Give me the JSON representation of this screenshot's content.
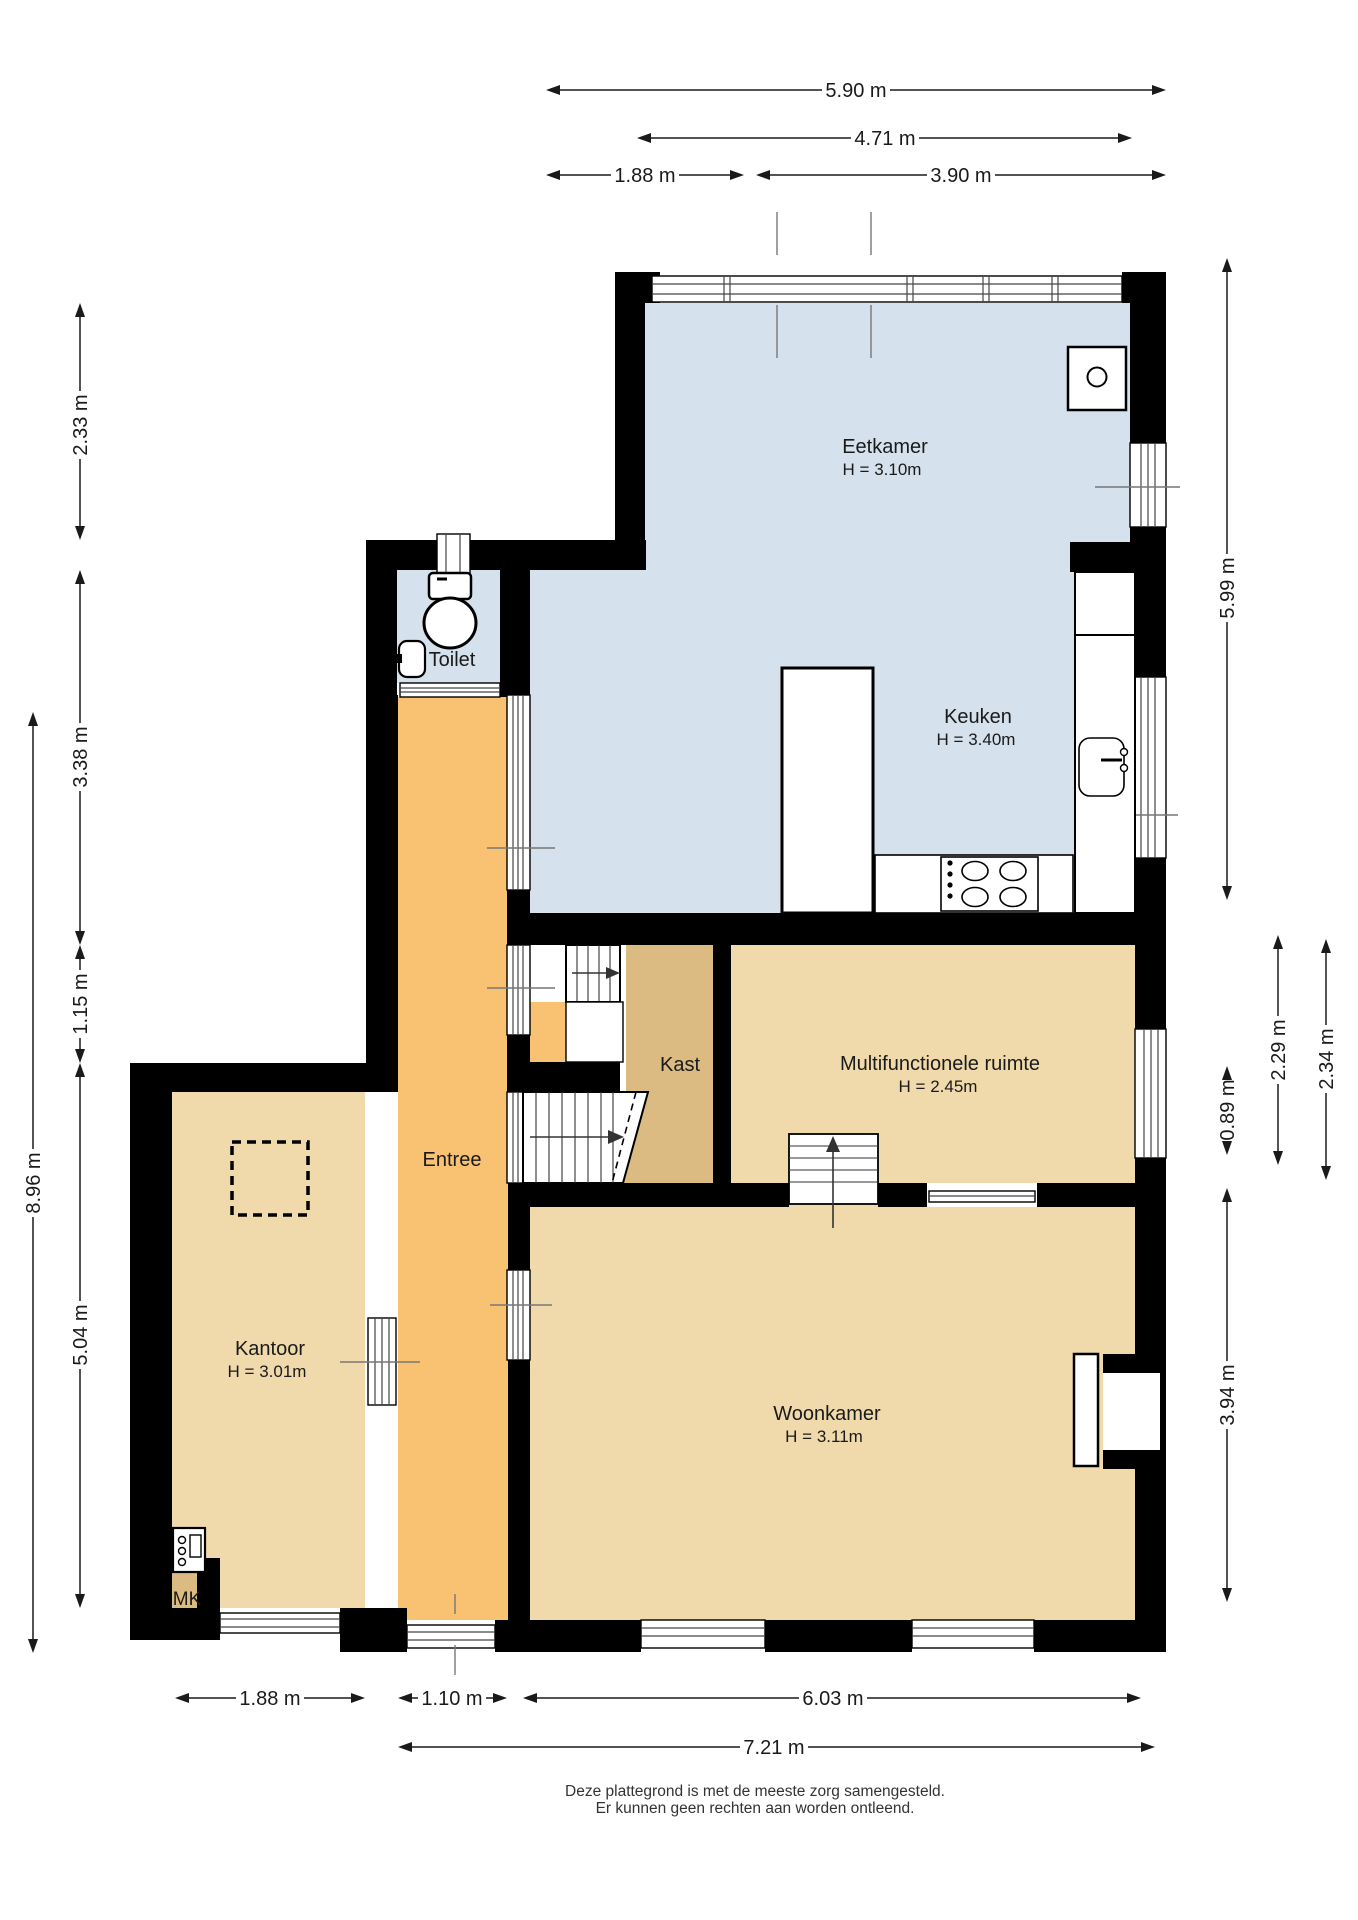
{
  "plan": {
    "type": "floor-plan",
    "rooms": {
      "eetkamer": {
        "label": "Eetkamer",
        "height": "H = 3.10m"
      },
      "keuken": {
        "label": "Keuken",
        "height": "H = 3.40m"
      },
      "toilet": {
        "label": "Toilet"
      },
      "entree": {
        "label": "Entree"
      },
      "kast": {
        "label": "Kast"
      },
      "multifunctionele_ruimte": {
        "label": "Multifunctionele ruimte",
        "height": "H = 2.45m"
      },
      "kantoor": {
        "label": "Kantoor",
        "height": "H = 3.01m"
      },
      "woonkamer": {
        "label": "Woonkamer",
        "height": "H = 3.11m"
      },
      "meterkast": {
        "label": "MK"
      }
    },
    "dimensions": [
      {
        "label": "5.90 m",
        "orient": "h",
        "pos": 90,
        "from": 546,
        "to": 1166,
        "labelpos": 856
      },
      {
        "label": "4.71 m",
        "orient": "h",
        "pos": 138,
        "from": 637,
        "to": 1132,
        "labelpos": 885
      },
      {
        "label": "1.88 m",
        "orient": "h",
        "pos": 175,
        "from": 546,
        "to": 744,
        "labelpos": 645
      },
      {
        "label": "3.90 m",
        "orient": "h",
        "pos": 175,
        "from": 756,
        "to": 1166,
        "labelpos": 961
      },
      {
        "label": "1.88 m",
        "orient": "h",
        "pos": 1698,
        "from": 175,
        "to": 365,
        "labelpos": 270
      },
      {
        "label": "1.10 m",
        "orient": "h",
        "pos": 1698,
        "from": 398,
        "to": 507,
        "labelpos": 452
      },
      {
        "label": "6.03 m",
        "orient": "h",
        "pos": 1698,
        "from": 523,
        "to": 1141,
        "labelpos": 833
      },
      {
        "label": "7.21 m",
        "orient": "h",
        "pos": 1747,
        "from": 398,
        "to": 1155,
        "labelpos": 774
      },
      {
        "label": "2.33 m",
        "orient": "v",
        "pos": 80,
        "from": 303,
        "to": 540,
        "labelpos": 425
      },
      {
        "label": "3.38 m",
        "orient": "v",
        "pos": 80,
        "from": 570,
        "to": 945,
        "labelpos": 757
      },
      {
        "label": "1.15 m",
        "orient": "v",
        "pos": 80,
        "from": 945,
        "to": 1063,
        "labelpos": 1004
      },
      {
        "label": "5.04 m",
        "orient": "v",
        "pos": 80,
        "from": 1063,
        "to": 1608,
        "labelpos": 1335
      },
      {
        "label": "8.96 m",
        "orient": "v",
        "pos": 33,
        "from": 712,
        "to": 1653,
        "labelpos": 1183
      },
      {
        "label": "5.99 m",
        "orient": "v",
        "pos": 1227,
        "from": 258,
        "to": 900,
        "labelpos": 588
      },
      {
        "label": "0.89 m",
        "orient": "v",
        "pos": 1227,
        "from": 1066,
        "to": 1155,
        "labelpos": 1110
      },
      {
        "label": "2.29 m",
        "orient": "v",
        "pos": 1278,
        "from": 935,
        "to": 1165,
        "labelpos": 1050
      },
      {
        "label": "2.34 m",
        "orient": "v",
        "pos": 1326,
        "from": 939,
        "to": 1180,
        "labelpos": 1059
      },
      {
        "label": "3.94 m",
        "orient": "v",
        "pos": 1227,
        "from": 1188,
        "to": 1602,
        "labelpos": 1395
      }
    ],
    "footer": {
      "line1": "Deze plattegrond is met de meeste zorg samengesteld.",
      "line2": "Er kunnen geen rechten aan worden ontleend."
    },
    "colors": {
      "wall": "#000000",
      "dining_kitchen_toilet": "#d5e1ec",
      "hallway_orange": "#f8c272",
      "room_tan": "#f0d9ab",
      "closet_tan": "#dcbb82",
      "dimension_ink": "#1a1a1a",
      "tick_gray": "#777777",
      "glass_white": "#ffffff"
    }
  }
}
